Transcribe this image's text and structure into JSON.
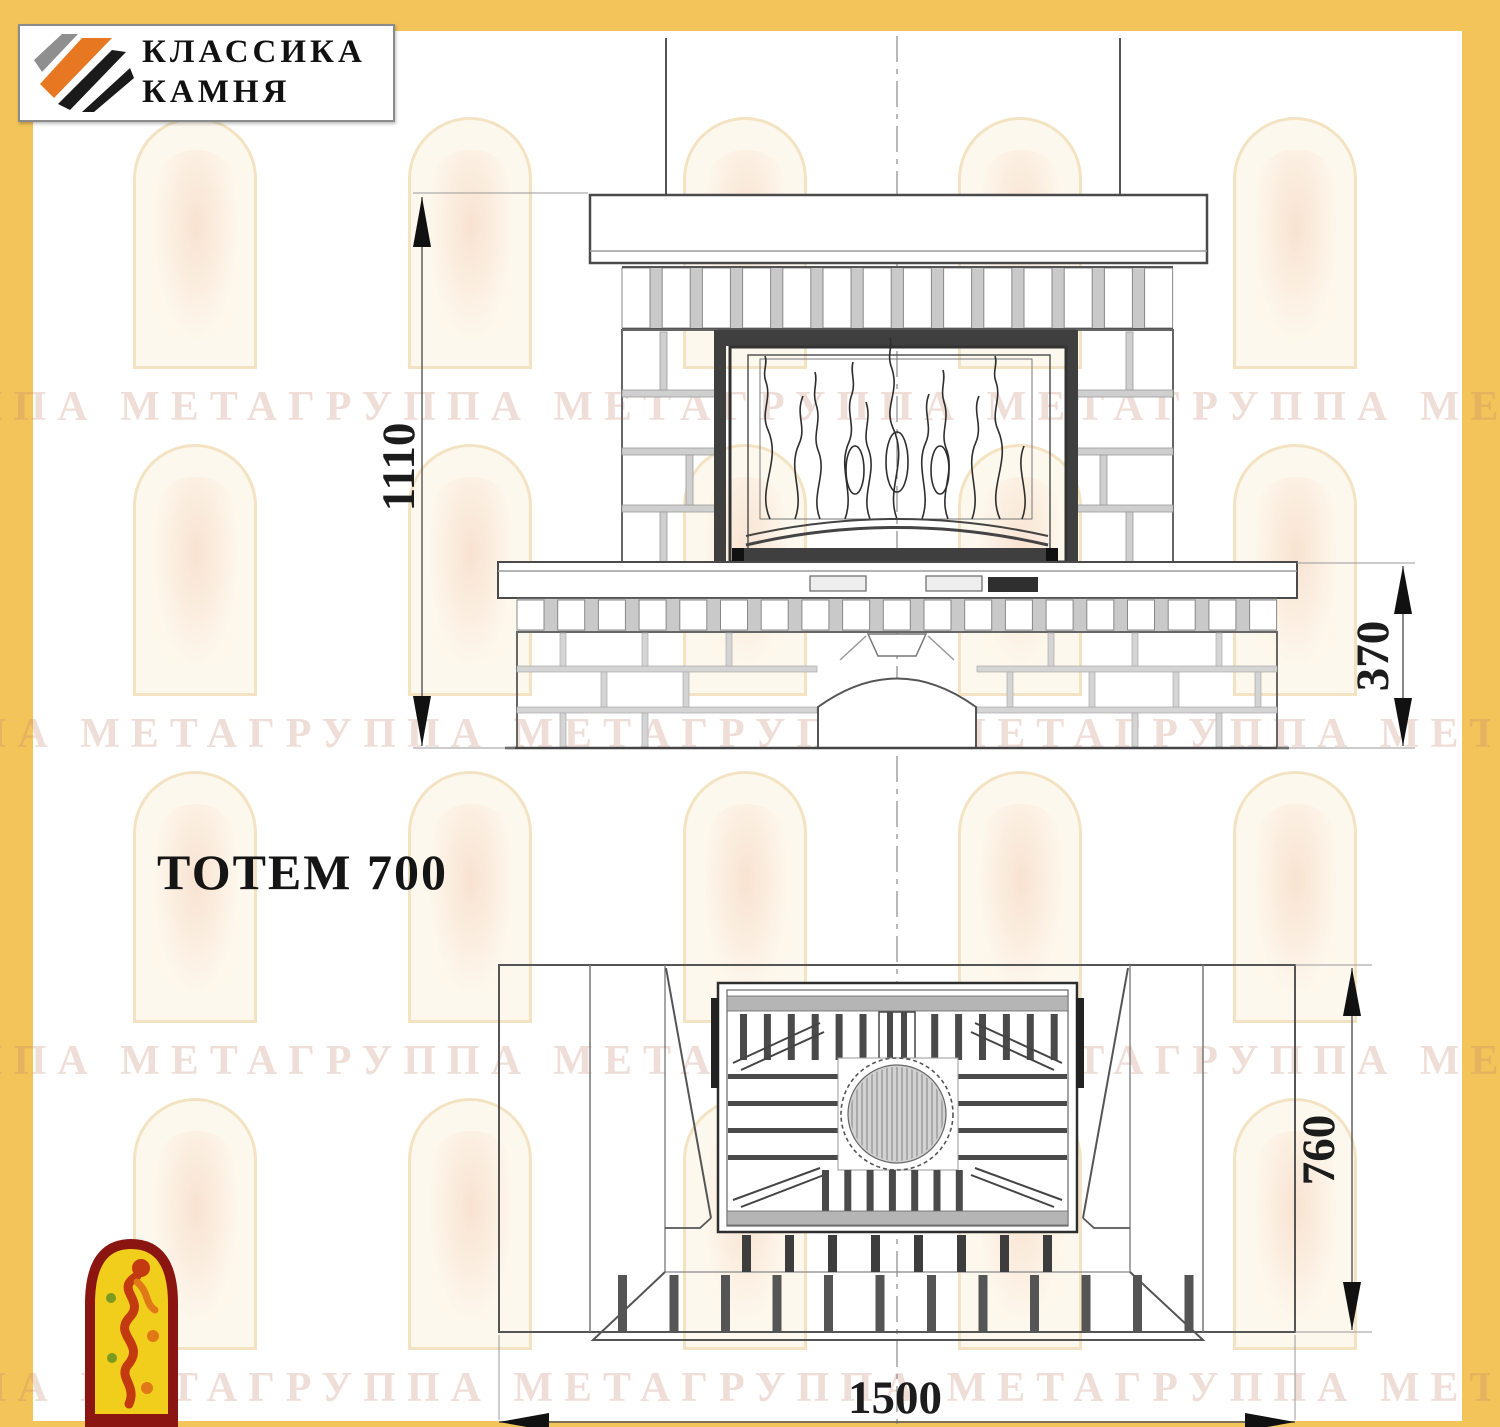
{
  "page": {
    "background_color": "#ffffff",
    "frame_color": "#F2C45A"
  },
  "logo": {
    "line1": "КЛАССИКА",
    "line2": "КАМНЯ",
    "emblem_icon": "diagonal-stone-stripes-icon",
    "stripe_colors": {
      "gray": "#8f8f8f",
      "orange": "#E87722",
      "black": "#1a1a1a"
    }
  },
  "title": "ТОТЕМ 700",
  "watermark": {
    "row_text": "ППА МЕТАГРУППА МЕТАГРУППА МЕТАГРУППА МЕТА",
    "arch_icon": "faded-arch-emblem-icon"
  },
  "mascot": {
    "icon": "dancing-flame-figure-icon",
    "colors": {
      "border": "#8B1510",
      "fill": "#F2CE1C",
      "figure": "#C33A10"
    }
  },
  "drawing": {
    "front_view": {
      "total_height_label": "1110",
      "bench_height_label": "370"
    },
    "plan_view": {
      "depth_label": "760",
      "width_label": "1500"
    }
  }
}
